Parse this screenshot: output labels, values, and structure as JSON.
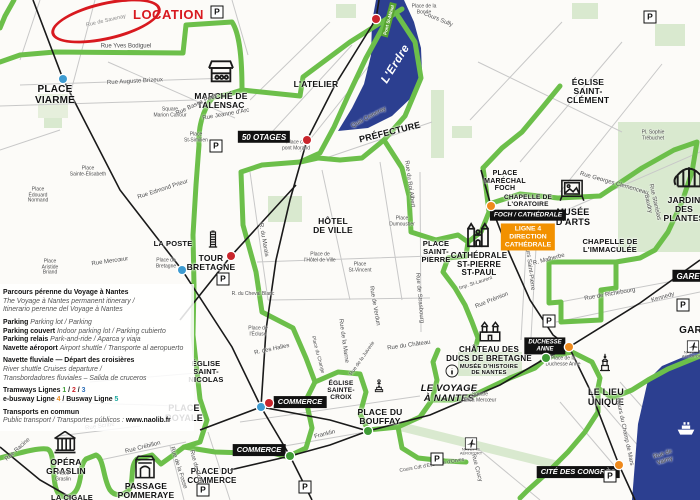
{
  "map": {
    "location_label": "LOCATION",
    "location_street": "Rue de Savenay",
    "river_label": "L'Erdre",
    "parking_letter": "P",
    "colors": {
      "route_green": "#6cbf4a",
      "water_blue": "#2c3f90",
      "location_red": "#d8191f",
      "badge_black": "#111111",
      "badge_orange": "#f29100",
      "tram_blue": "#3d9bd1",
      "tram_red": "#c9252c",
      "tram_green": "#3f9c35",
      "busway_orange": "#ef8a1c"
    },
    "pois": [
      {
        "id": "place-viarme",
        "text": "PLACE\nVIARME",
        "x": 55,
        "y": 85,
        "s": 10
      },
      {
        "id": "marche-de-talensac",
        "text": "MARCHÉ DE\nTALENSAC",
        "x": 221,
        "y": 92,
        "s": 8.5
      },
      {
        "id": "l-atelier",
        "text": "L'ATELIER",
        "x": 316,
        "y": 80,
        "s": 8.5
      },
      {
        "id": "prefecture",
        "text": "PRÉFECTURE",
        "x": 390,
        "y": 128,
        "s": 9,
        "rot": -14
      },
      {
        "id": "eglise-saint-clement",
        "text": "ÉGLISE\nSAINT-\nCLÉMENT",
        "x": 588,
        "y": 78,
        "s": 8.5
      },
      {
        "id": "hotel-de-ville",
        "text": "HÔTEL\nDE VILLE",
        "x": 333,
        "y": 217,
        "s": 8.5
      },
      {
        "id": "la-poste",
        "text": "LA POSTE",
        "x": 173,
        "y": 240,
        "s": 7.5
      },
      {
        "id": "tour-bretagne",
        "text": "TOUR\nBRETAGNE",
        "x": 211,
        "y": 254,
        "s": 8.5
      },
      {
        "id": "place-marechal-foch",
        "text": "PLACE\nMARÉCHAL\nFOCH",
        "x": 505,
        "y": 170,
        "s": 7
      },
      {
        "id": "chapelle-de-l-oratoire",
        "text": "CHAPELLE DE\nL'ORATOIRE",
        "x": 528,
        "y": 194,
        "s": 6.5
      },
      {
        "id": "musee-d-arts",
        "text": "MUSÉE\nD'ARTS",
        "x": 573,
        "y": 208,
        "s": 9
      },
      {
        "id": "chapelle-de-l-immaculee",
        "text": "CHAPELLE DE\nL'IMMACULÉE",
        "x": 610,
        "y": 238,
        "s": 7.5
      },
      {
        "id": "jardin-des-plantes",
        "text": "JARDIN\nDES PLANTES",
        "x": 684,
        "y": 196,
        "s": 8.5
      },
      {
        "id": "place-saint-pierre",
        "text": "PLACE\nSAINT-\nPIERRE",
        "x": 436,
        "y": 240,
        "s": 7.5
      },
      {
        "id": "cathedrale-st-pierre-st-paul",
        "text": "CATHÉDRALE\nST-PIERRE\nST-PAUL",
        "x": 479,
        "y": 252,
        "s": 8
      },
      {
        "id": "eglise-saint-nicolas",
        "text": "ÉGLISE\nSAINT-\nNICOLAS",
        "x": 206,
        "y": 360,
        "s": 7.5
      },
      {
        "id": "place-royale",
        "text": "PLACE\nROYALE",
        "x": 184,
        "y": 404,
        "s": 9
      },
      {
        "id": "opera-graslin",
        "text": "OPÉRA\nGRASLIN",
        "x": 66,
        "y": 458,
        "s": 8.5
      },
      {
        "id": "la-cigale",
        "text": "LA CIGALE",
        "x": 72,
        "y": 494,
        "s": 7.5
      },
      {
        "id": "passage-pommeraye",
        "text": "PASSAGE\nPOMMERAYE",
        "x": 146,
        "y": 482,
        "s": 8.5
      },
      {
        "id": "place-du-commerce",
        "text": "PLACE DU\nCOMMERCE",
        "x": 212,
        "y": 468,
        "s": 8
      },
      {
        "id": "eglise-sainte-croix",
        "text": "ÉGLISE\nSAINTE-\nCROIX",
        "x": 341,
        "y": 380,
        "s": 6.5
      },
      {
        "id": "place-du-bouffay",
        "text": "PLACE DU\nBOUFFAY",
        "x": 380,
        "y": 408,
        "s": 8.5
      },
      {
        "id": "le-voyage-a-nantes",
        "text": "LE VOYAGE\nÀ NANTES",
        "x": 449,
        "y": 384,
        "s": 9.5,
        "it": true
      },
      {
        "id": "chateau-des-ducs",
        "text": "CHÂTEAU DES\nDUCS DE BRETAGNE",
        "x": 489,
        "y": 346,
        "s": 8
      },
      {
        "id": "musee-d-histoire",
        "text": "MUSÉE D'HISTOIRE\nDE NANTES",
        "x": 489,
        "y": 364,
        "s": 5.8
      },
      {
        "id": "le-lieu-unique",
        "text": "LE LIEU\nUNIQUE",
        "x": 606,
        "y": 388,
        "s": 9
      },
      {
        "id": "gare",
        "text": "GARE",
        "x": 694,
        "y": 326,
        "s": 10
      }
    ],
    "streets": [
      {
        "t": "Rue Yves Bodiguel",
        "x": 126,
        "y": 47
      },
      {
        "t": "Rue Auguste Brizeux",
        "x": 135,
        "y": 82,
        "r": -3
      },
      {
        "t": "Square\nMarion Cahour",
        "x": 170,
        "y": 113,
        "s": 5
      },
      {
        "t": "Place\nSt-Similien",
        "x": 196,
        "y": 138,
        "s": 5
      },
      {
        "t": "Rue Basse Porte",
        "x": 197,
        "y": 105,
        "r": -25
      },
      {
        "t": "Rue Jeanne d'Arc",
        "x": 226,
        "y": 115,
        "r": -10
      },
      {
        "t": "Place de la\nBonde",
        "x": 424,
        "y": 10,
        "s": 5
      },
      {
        "t": "Cours Sully",
        "x": 438,
        "y": 20,
        "r": 22
      },
      {
        "t": "Quai Ceineray",
        "x": 369,
        "y": 118,
        "r": -28
      },
      {
        "t": "Place du\npont Morand",
        "x": 296,
        "y": 146,
        "s": 5
      },
      {
        "t": "Rue Edmond Prieur",
        "x": 163,
        "y": 190,
        "r": -18
      },
      {
        "t": "Place\nÉdouard\nNormand",
        "x": 38,
        "y": 196,
        "s": 5
      },
      {
        "t": "Place\nSainte-Élisabeth",
        "x": 88,
        "y": 172,
        "s": 5
      },
      {
        "t": "Place\nAristide\nBriand",
        "x": 50,
        "y": 268,
        "s": 5
      },
      {
        "t": "Place de\nBretagne",
        "x": 166,
        "y": 264,
        "s": 5
      },
      {
        "t": "Rue Mercœur",
        "x": 110,
        "y": 262,
        "r": -8
      },
      {
        "t": "R. du Cheval Blanc",
        "x": 253,
        "y": 295,
        "s": 5
      },
      {
        "t": "R. du Marais",
        "x": 263,
        "y": 240,
        "r": 80
      },
      {
        "t": "Rue de Strasbourg",
        "x": 419,
        "y": 298,
        "r": 85
      },
      {
        "t": "Rue de Verdun",
        "x": 374,
        "y": 306,
        "r": 80
      },
      {
        "t": "Place\nDumoustier",
        "x": 402,
        "y": 222,
        "s": 5
      },
      {
        "t": "Place\nSt-Vincent",
        "x": 360,
        "y": 268,
        "s": 5
      },
      {
        "t": "Place de\nl'Hôtel de Ville",
        "x": 320,
        "y": 258,
        "s": 5
      },
      {
        "t": "Rue du Roi Albert",
        "x": 409,
        "y": 184,
        "r": 82
      },
      {
        "t": "Rue Prémion",
        "x": 492,
        "y": 301,
        "r": -22
      },
      {
        "t": "Imp. St-Laurent",
        "x": 476,
        "y": 284,
        "r": -18,
        "s": 5
      },
      {
        "t": "Cours Saint-Pierre",
        "x": 529,
        "y": 266,
        "r": 83
      },
      {
        "t": "R. Malherbe",
        "x": 549,
        "y": 260,
        "r": -15
      },
      {
        "t": "Rue de Richebourg",
        "x": 610,
        "y": 295,
        "r": -10
      },
      {
        "t": "Kennedy",
        "x": 663,
        "y": 298,
        "r": -16
      },
      {
        "t": "Rue Stanislas Baudry",
        "x": 651,
        "y": 203,
        "r": 77
      },
      {
        "t": "Rue Georges Clemenceau",
        "x": 614,
        "y": 184,
        "r": 16
      },
      {
        "t": "Pl. Sophie\nTrébuchet",
        "x": 653,
        "y": 136,
        "s": 5
      },
      {
        "t": "Rue de la Marne",
        "x": 343,
        "y": 341,
        "r": 82
      },
      {
        "t": "Place du Change",
        "x": 317,
        "y": 355,
        "r": 75,
        "s": 5
      },
      {
        "t": "R. des Halles",
        "x": 272,
        "y": 350,
        "r": -12
      },
      {
        "t": "Place de\nl'Écluse",
        "x": 258,
        "y": 332,
        "s": 5
      },
      {
        "t": "Rue de la Juiverie",
        "x": 363,
        "y": 359,
        "r": -55,
        "s": 5
      },
      {
        "t": "Rue du Château",
        "x": 409,
        "y": 346,
        "r": -8
      },
      {
        "t": "Rue Crébillon",
        "x": 143,
        "y": 448,
        "r": -14
      },
      {
        "t": "Rue Scribe",
        "x": 100,
        "y": 427,
        "r": -8
      },
      {
        "t": "Rue de la Fosse",
        "x": 178,
        "y": 468,
        "r": 72
      },
      {
        "t": "Rue de Gorges",
        "x": 196,
        "y": 470,
        "r": 75
      },
      {
        "t": "Franklin",
        "x": 325,
        "y": 435,
        "r": -14
      },
      {
        "t": "Rue Crucy",
        "x": 476,
        "y": 468,
        "r": 75
      },
      {
        "t": "Square\nÉlisa Mercœur",
        "x": 480,
        "y": 398,
        "s": 5
      },
      {
        "t": "Rue de Valmy",
        "x": 664,
        "y": 458,
        "r": -18
      },
      {
        "t": "Cours du Champ de Mars",
        "x": 624,
        "y": 432,
        "r": 78
      },
      {
        "t": "Place de la\nDuchesse Anne",
        "x": 563,
        "y": 362,
        "s": 5
      },
      {
        "t": "Cours Cdt d'Estienne d'Orves",
        "x": 432,
        "y": 466,
        "r": -10,
        "s": 5
      },
      {
        "t": "Place\nGraslin",
        "x": 63,
        "y": 477,
        "s": 5
      },
      {
        "t": "Rue Racine",
        "x": 18,
        "y": 450,
        "r": -42
      },
      {
        "t": "NAVETTE\nAÉROPORT",
        "x": 471,
        "y": 452,
        "s": 4
      },
      {
        "t": "NAVETTE\nAÉROPORT",
        "x": 693,
        "y": 355,
        "s": 4
      }
    ],
    "badges": [
      {
        "id": "badge-50-otages",
        "t": "50 OTAGES",
        "x": 264,
        "y": 137,
        "type": "black",
        "s": 8
      },
      {
        "id": "badge-commerce-upper",
        "t": "COMMERCE",
        "x": 300,
        "y": 402,
        "type": "black",
        "s": 7.5
      },
      {
        "id": "badge-commerce-lower",
        "t": "COMMERCE",
        "x": 259,
        "y": 450,
        "type": "black",
        "s": 7.5
      },
      {
        "id": "badge-duchesse-anne",
        "t": "DUCHESSE\nANNE",
        "x": 545,
        "y": 346,
        "type": "black",
        "s": 6
      },
      {
        "id": "badge-cite-des-congres",
        "t": "CITÉ DES CONGRÈS",
        "x": 578,
        "y": 472,
        "type": "black",
        "s": 7.5
      },
      {
        "id": "badge-gare",
        "t": "GARE",
        "x": 688,
        "y": 276,
        "type": "black",
        "s": 8
      },
      {
        "id": "badge-foch-cathedrale",
        "t": "FOCH / CATHÉDRALE",
        "x": 528,
        "y": 215,
        "type": "black",
        "s": 6.5
      },
      {
        "id": "badge-ligne4",
        "t": "LIGNE 4\nDIRECTION\nCATHÉDRALE",
        "x": 528,
        "y": 237,
        "type": "orange",
        "s": 6.8
      },
      {
        "id": "badge-pont-st-mihiel",
        "t": "Pont St-Mihiel",
        "x": 389,
        "y": 20,
        "type": "green",
        "s": 4.6,
        "rot": -75
      }
    ],
    "stations": [
      {
        "x": 63,
        "y": 79,
        "c": "blue"
      },
      {
        "x": 182,
        "y": 270,
        "c": "blue"
      },
      {
        "x": 261,
        "y": 407,
        "c": "blue"
      },
      {
        "x": 307,
        "y": 140,
        "c": "red"
      },
      {
        "x": 376,
        "y": 19,
        "c": "red"
      },
      {
        "x": 269,
        "y": 403,
        "c": "red"
      },
      {
        "x": 231,
        "y": 256,
        "c": "red"
      },
      {
        "x": 290,
        "y": 456,
        "c": "green"
      },
      {
        "x": 368,
        "y": 431,
        "c": "green"
      },
      {
        "x": 546,
        "y": 358,
        "c": "green"
      },
      {
        "x": 491,
        "y": 206,
        "c": "orange"
      },
      {
        "x": 569,
        "y": 347,
        "c": "orange"
      },
      {
        "x": 619,
        "y": 465,
        "c": "orange"
      }
    ],
    "parkings": [
      {
        "x": 217,
        "y": 12
      },
      {
        "x": 650,
        "y": 17
      },
      {
        "x": 216,
        "y": 146
      },
      {
        "x": 223,
        "y": 279
      },
      {
        "x": 549,
        "y": 321
      },
      {
        "x": 683,
        "y": 305
      },
      {
        "x": 437,
        "y": 459
      },
      {
        "x": 305,
        "y": 487
      },
      {
        "x": 203,
        "y": 490
      },
      {
        "x": 610,
        "y": 476
      }
    ],
    "icons": [
      {
        "id": "market",
        "x": 221,
        "y": 56,
        "w": 44,
        "h": 32
      },
      {
        "id": "tower",
        "x": 213,
        "y": 226,
        "w": 20,
        "h": 27
      },
      {
        "id": "cathedral",
        "x": 478,
        "y": 220,
        "w": 32,
        "h": 30
      },
      {
        "id": "castle",
        "x": 490,
        "y": 318,
        "w": 42,
        "h": 26
      },
      {
        "id": "frame",
        "x": 572,
        "y": 174,
        "w": 27,
        "h": 31
      },
      {
        "id": "greenhouse",
        "x": 689,
        "y": 157,
        "w": 34,
        "h": 36
      },
      {
        "id": "opera",
        "x": 65,
        "y": 428,
        "w": 40,
        "h": 28
      },
      {
        "id": "pommeraye",
        "x": 145,
        "y": 454,
        "w": 30,
        "h": 27
      },
      {
        "id": "statue",
        "x": 379,
        "y": 366,
        "w": 16,
        "h": 40
      },
      {
        "id": "lieu-unique",
        "x": 605,
        "y": 341,
        "w": 20,
        "h": 44
      },
      {
        "id": "info",
        "x": 452,
        "y": 363,
        "w": 16,
        "h": 16
      },
      {
        "id": "plane",
        "x": 471,
        "y": 437,
        "w": 13,
        "h": 13
      },
      {
        "id": "plane",
        "x": 693,
        "y": 340,
        "w": 13,
        "h": 13
      },
      {
        "id": "ferry",
        "x": 686,
        "y": 418,
        "w": 30,
        "h": 20
      }
    ],
    "legend": {
      "rows": [
        {
          "b": "Parcours pérenne du Voyage à Nantes"
        },
        {
          "i": "The Voyage à Nantes permanent itinerary /"
        },
        {
          "i": "Itinerario perenne del Voyage à Nantes"
        },
        {
          "gap": true,
          "b": "Parking ",
          "i": "Parking lot / Parking"
        },
        {
          "b": "Parking couvert ",
          "i": "Indoor parking lot / Parking cubierto"
        },
        {
          "b": "Parking relais ",
          "i": "Park-and-ride / Aparca y viaja"
        },
        {
          "b": "Navette aéroport ",
          "i": "Airport shuttle / Transporte al aeropuerto"
        },
        {
          "gap": true,
          "b": "Navette fluviale — Départ des croisières"
        },
        {
          "i": "River shuttle   Cruises departure /"
        },
        {
          "i": "Transbordadores fluviales – Salida de cruceros"
        },
        {
          "gap": true,
          "seg": [
            [
              "b",
              "Tramways Lignes "
            ],
            [
              "g",
              "1"
            ],
            [
              "b",
              " / "
            ],
            [
              "r",
              "2"
            ],
            [
              "b",
              " / "
            ],
            [
              "bl",
              "3"
            ]
          ]
        },
        {
          "seg": [
            [
              "b",
              "e-busway Ligne "
            ],
            [
              "o",
              "4"
            ],
            [
              "b",
              " / Busway Ligne "
            ],
            [
              "t",
              "5"
            ]
          ]
        },
        {
          "gap": true,
          "b": "Transports en commun"
        },
        {
          "i": "Public transport / Transportes públicos : ",
          "bw": "www.naolib.fr"
        }
      ]
    }
  }
}
